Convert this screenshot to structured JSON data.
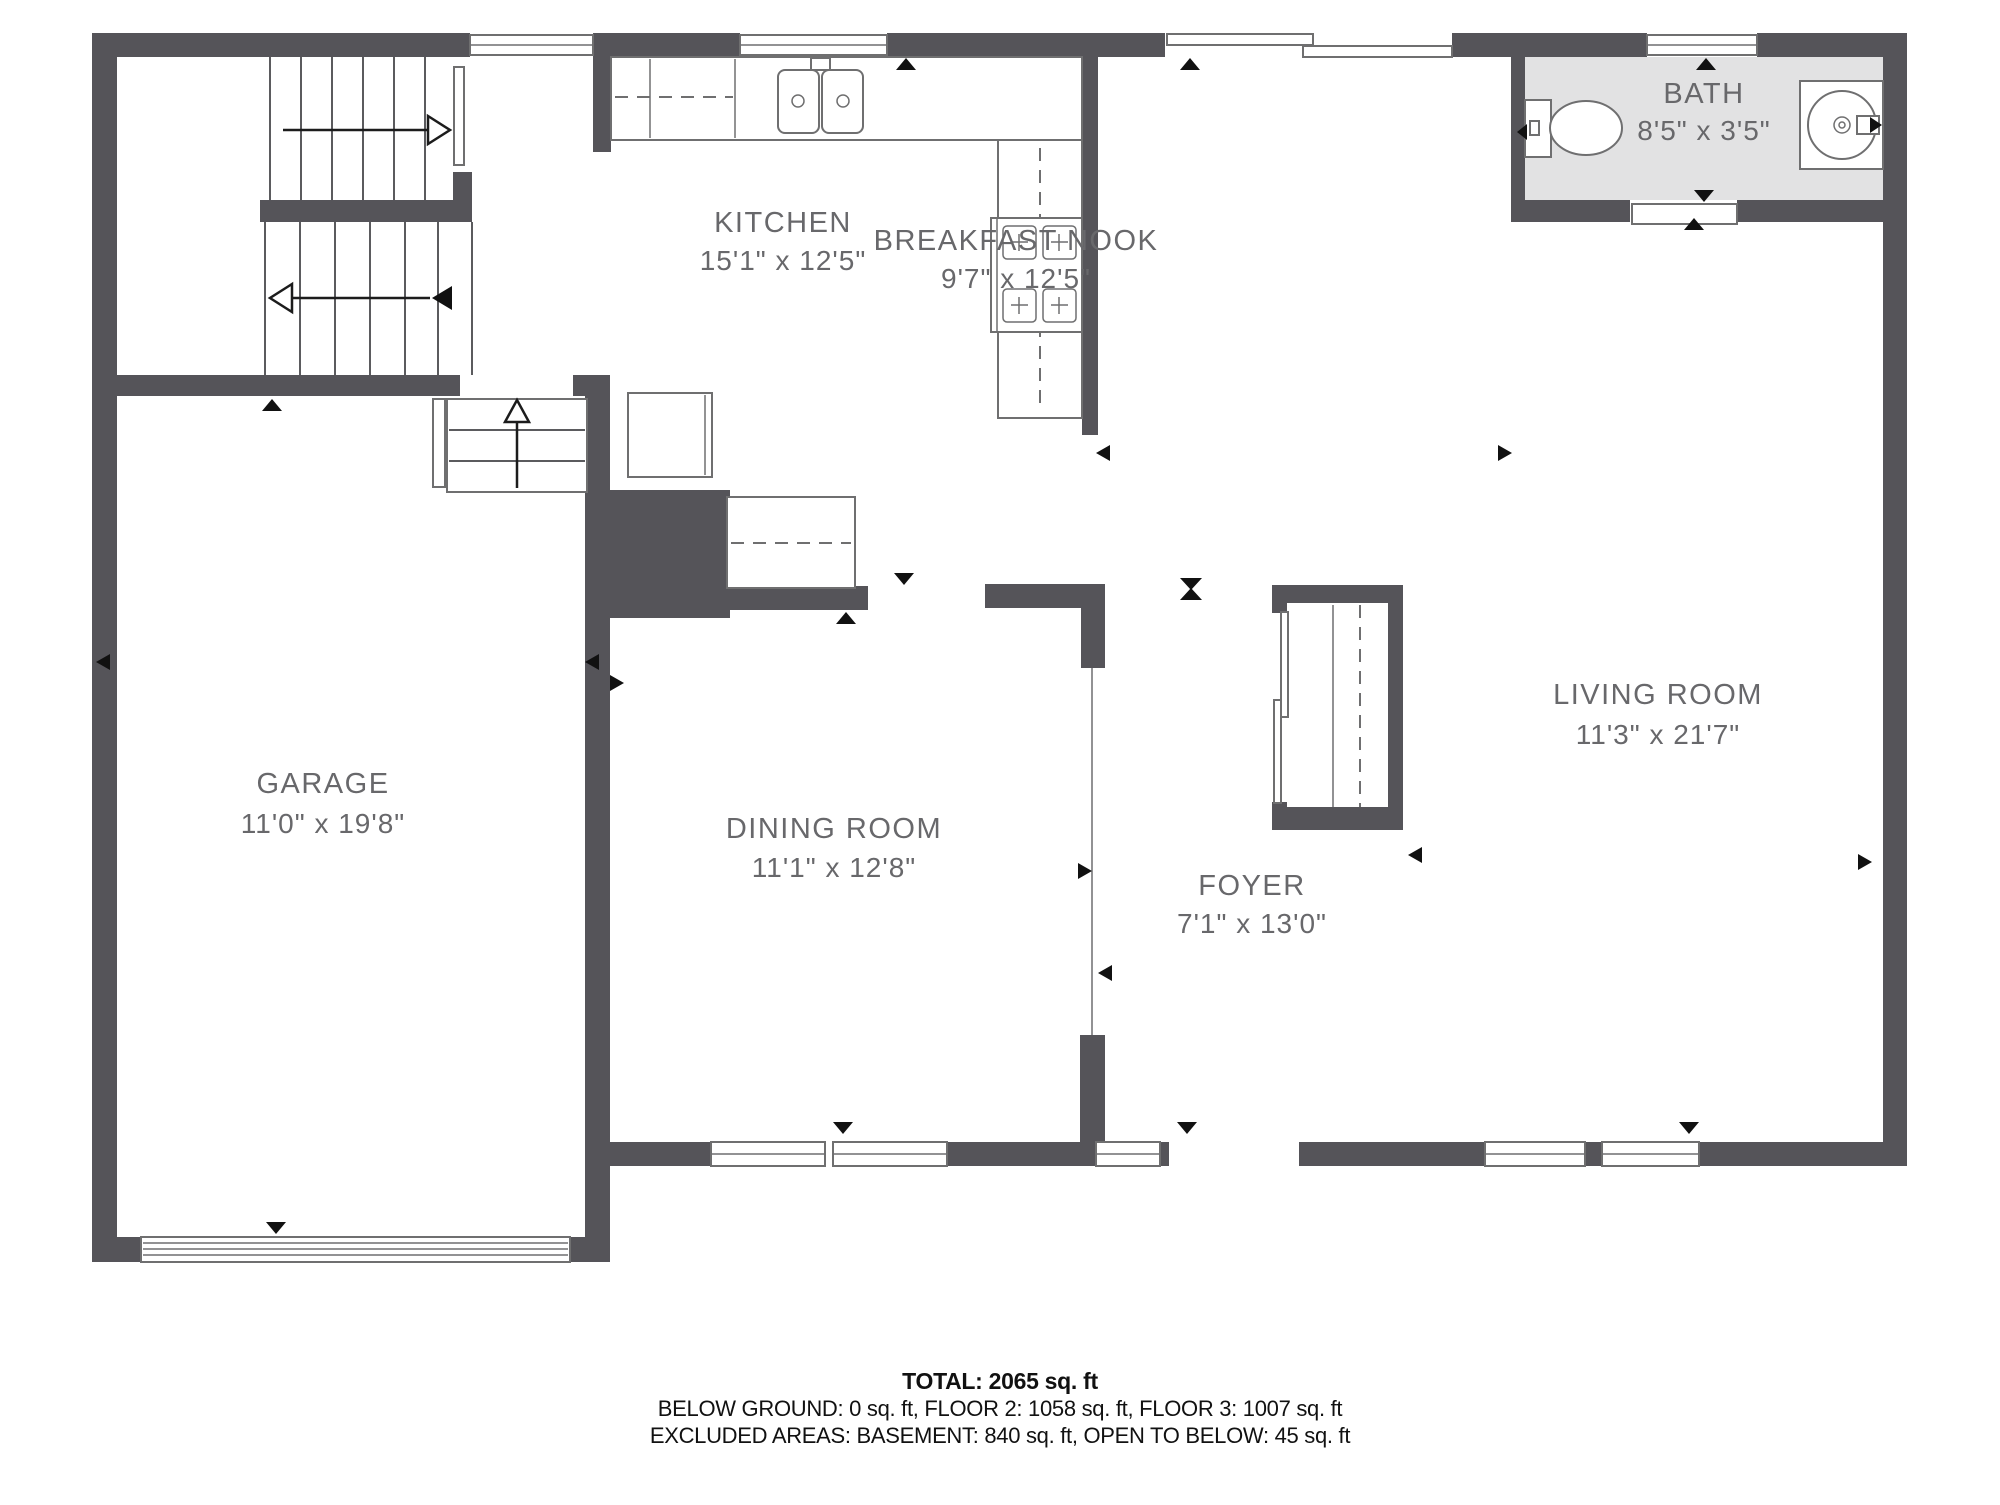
{
  "rooms": {
    "kitchen": {
      "name": "KITCHEN",
      "dims": "15'1\" x 12'5\""
    },
    "breakfast_nook": {
      "name": "BREAKFAST NOOK",
      "dims": "9'7\" x 12'5\""
    },
    "bath": {
      "name": "BATH",
      "dims": "8'5\" x 3'5\""
    },
    "garage": {
      "name": "GARAGE",
      "dims": "11'0\" x 19'8\""
    },
    "dining_room": {
      "name": "DINING ROOM",
      "dims": "11'1\" x 12'8\""
    },
    "foyer": {
      "name": "FOYER",
      "dims": "7'1\" x 13'0\""
    },
    "living_room": {
      "name": "LIVING ROOM",
      "dims": "11'3\" x 21'7\""
    }
  },
  "summary": {
    "total": "TOTAL: 2065 sq. ft",
    "floors": "BELOW GROUND: 0 sq. ft, FLOOR 2: 1058 sq. ft, FLOOR 3: 1007 sq. ft",
    "excluded": "EXCLUDED AREAS: BASEMENT: 840 sq. ft, OPEN TO BELOW: 45 sq. ft"
  },
  "colors": {
    "wall": "#555459",
    "bath_fill": "#e2e2e3",
    "fixture_outline": "#6f6f70",
    "label_text": "#68686b",
    "summary_text": "#111111",
    "marker": "#111111"
  }
}
